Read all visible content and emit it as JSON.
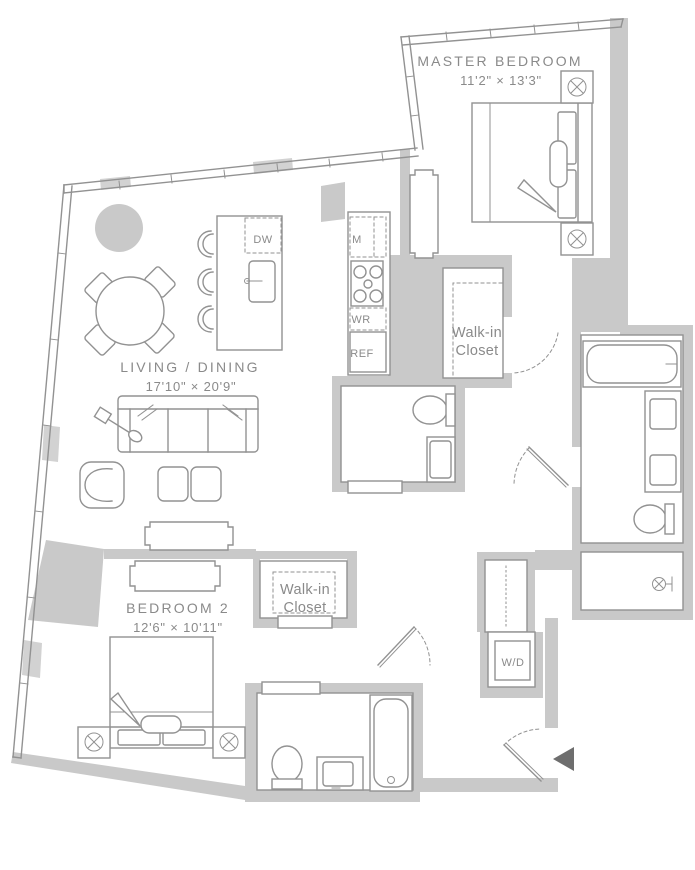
{
  "plan": {
    "title": "Two bedroom apartment floor plan",
    "rooms": {
      "master_bedroom": {
        "label": "MASTER BEDROOM",
        "dimensions": "11'2\" × 13'3\""
      },
      "living_dining": {
        "label": "LIVING / DINING",
        "dimensions": "17'10\" × 20'9\""
      },
      "bedroom_2": {
        "label": "BEDROOM 2",
        "dimensions": "12'6\" × 10'11\""
      },
      "master_walk_in_closet": {
        "line1": "Walk-in",
        "line2": "Closet"
      },
      "bedroom2_walk_in_closet": {
        "line1": "Walk-in",
        "line2": "Closet"
      }
    },
    "appliances": {
      "dishwasher": "DW",
      "microwave": "M",
      "wine_refrigerator": "WR",
      "refrigerator": "REF",
      "washer_dryer": "W/D"
    },
    "colors": {
      "wall_fill": "#c9c9c9",
      "line": "#929292",
      "text": "#8a8a8a",
      "entry_arrow": "#6e6e6e",
      "background": "#ffffff"
    }
  }
}
